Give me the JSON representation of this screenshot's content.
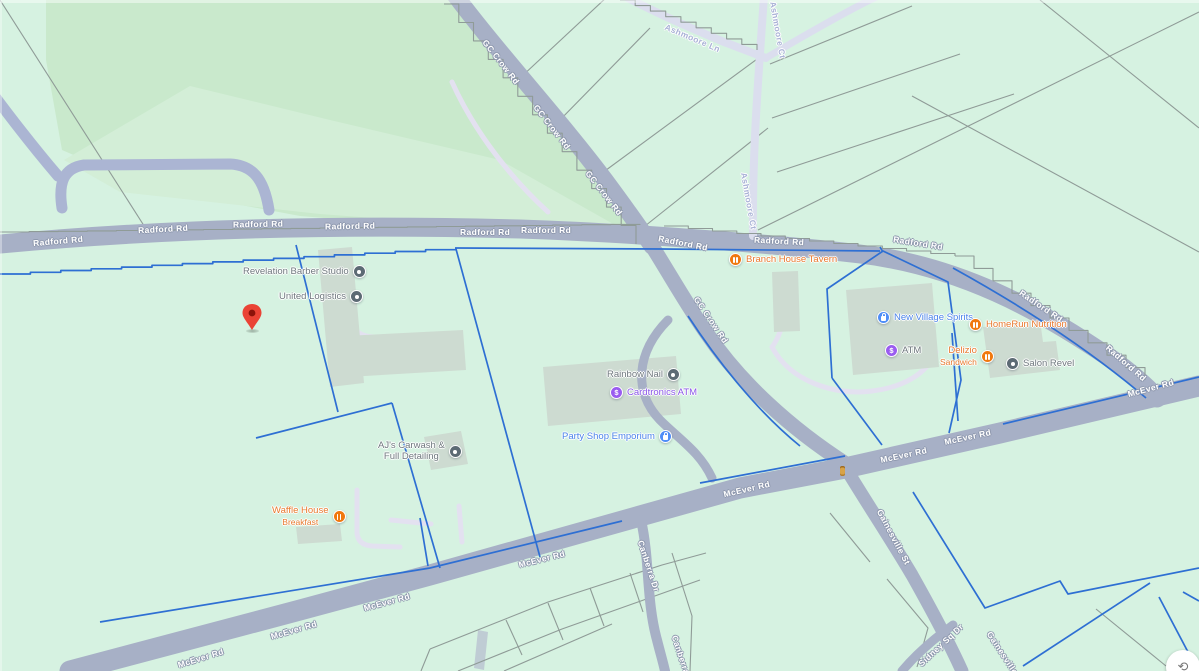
{
  "map": {
    "kind": "street-map-view",
    "roads": {
      "radford": "Radford Rd",
      "mcever": "McEver Rd",
      "gc_crow": "GC Crow Rd",
      "ashmoore_ln": "Ashmoore Ln",
      "ashmoore_ct": "Ashmoore Ct",
      "canberra": "Canberra Dr",
      "gainesville": "Gainesville St",
      "sidney_sq": "Sidney Sq Dr"
    },
    "pois": {
      "revelation": "Revelation Barber Studio",
      "united": "United Logistics",
      "branch": "Branch House Tavern",
      "new_village": "New Village Spirits",
      "atm": "ATM",
      "homerun": "HomeRun Nutrition",
      "delizio_1": "Delizio",
      "delizio_2": "Sandwich",
      "salon": "Salon Revel",
      "rainbow": "Rainbow Nail",
      "cardtronics": "Cardtronics ATM",
      "party": "Party Shop Emporium",
      "ajs_1": "AJ's Carwash &",
      "ajs_2": "Full Detailing",
      "waffle_1": "Waffle House",
      "waffle_2": "Breakfast"
    },
    "icons": {
      "atm_glyph": "$",
      "compass_glyph": "⟲"
    },
    "colors": {
      "bg": "#d6f2e1",
      "park": "#c9e9cc",
      "park_light": "#d3eed7",
      "road": "#a7b0c6",
      "road_minor": "#abb5d3",
      "road_lavender": "#dbdeee",
      "drive_lavender": "#e3e1f0",
      "parcel_blue": "#2e6fd3",
      "parcel_gray": "#8f9b97",
      "building": "#cddbd1",
      "building_bar": "#bfccd4",
      "road_label": "#ffffff",
      "road_label_halo": "#8d97ad",
      "lavender_label": "#a9b2d6",
      "label_gray": "#6f787e",
      "label_food": "#e8792e",
      "label_shop": "#4b83ea",
      "label_purple": "#8a55e8",
      "icon_gray": "#5c6a74",
      "icon_food": "#f0780f",
      "icon_shop": "#4e8df7",
      "icon_purple": "#9a5cf0",
      "pin": "#ea4335",
      "pin_inner": "#8c130a",
      "signal": "#d8a348",
      "halo": "#ffffff"
    }
  }
}
